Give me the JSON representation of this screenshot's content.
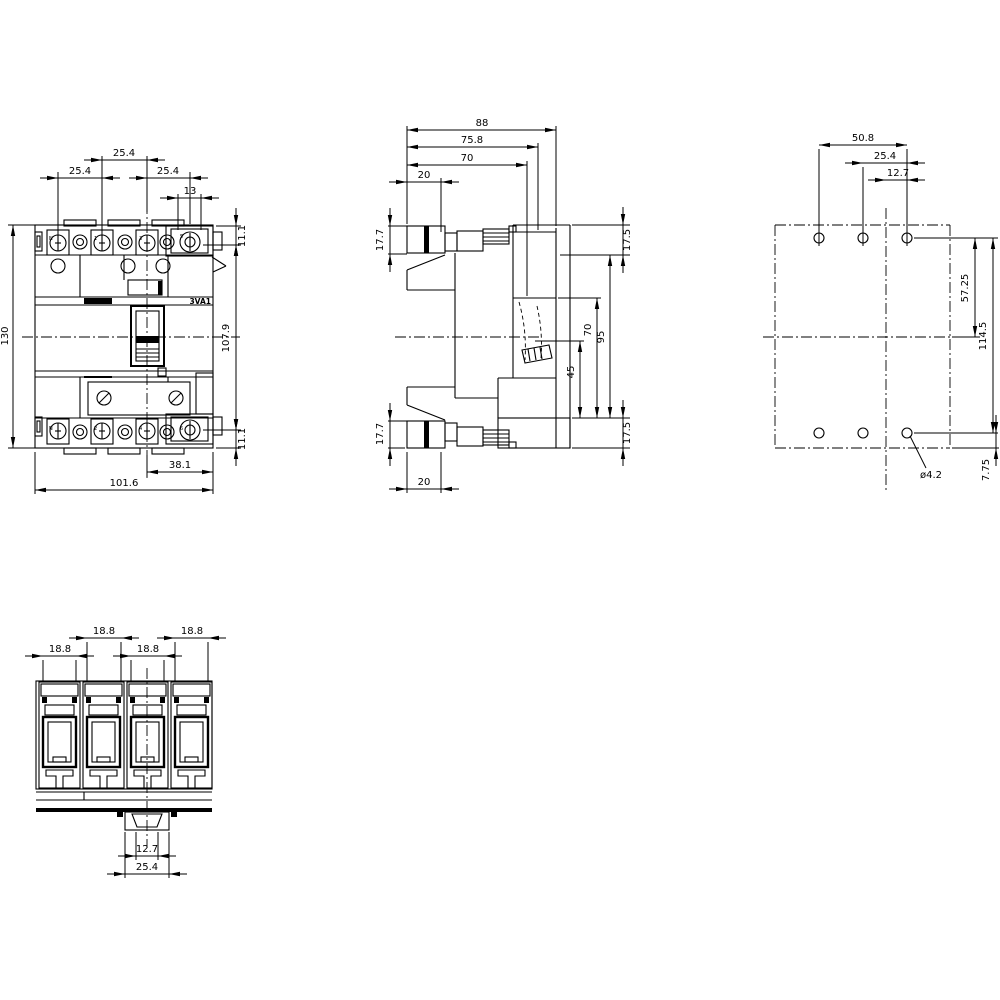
{
  "views": {
    "front": {
      "product_label": "3VA1",
      "pole_labels_top": [
        "N",
        "1",
        "3",
        "5"
      ],
      "pole_labels_bottom": [
        "N",
        "2",
        "4",
        "6"
      ],
      "dims": {
        "pitch_2_3": "25.4",
        "pitch_1_2": "25.4",
        "pitch_3_4": "25.4",
        "terminal_width": "13",
        "top_terminal_offset": "11.1",
        "overall_height": "130",
        "terminal_span": "107.9",
        "bottom_terminal_offset": "11.1",
        "center_to_edge": "38.1",
        "overall_width": "101.6"
      }
    },
    "side": {
      "dims": {
        "overall_depth": "88",
        "depth_to_mount": "75.8",
        "depth_front": "70",
        "terminal_depth_top": "20",
        "terminal_height_top": "17.7",
        "top_section": "17.5",
        "handle_cutout": "45",
        "front_recess": "70",
        "body_section": "95",
        "bottom_section": "17.5",
        "terminal_height_bottom": "17.7",
        "terminal_depth_bottom": "20"
      }
    },
    "rear": {
      "dims": {
        "hole_span": "50.8",
        "hole_pitch": "25.4",
        "hole_offset": "12.7",
        "center_to_hole_row": "57.25",
        "hole_row_span": "114.5",
        "bottom_edge_offset": "7.75",
        "hole_diameter": "ø4.2"
      }
    },
    "bottom": {
      "dims": {
        "slot_width_pole2": "18.8",
        "slot_width_pole4": "18.8",
        "slot_width_pole1": "18.8",
        "slot_width_pole3": "18.8",
        "tab_inner_width": "12.7",
        "tab_outer_width": "25.4"
      }
    }
  }
}
